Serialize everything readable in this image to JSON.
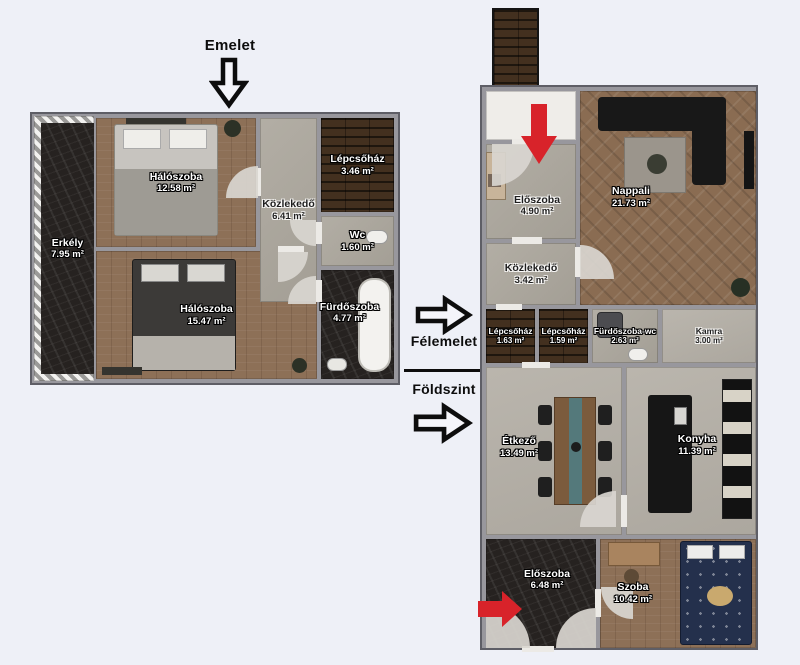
{
  "page": {
    "background": "#eef0f7"
  },
  "headings": {
    "emelet": "Emelet",
    "felemelet": "Félemelet",
    "foldszint": "Földszint"
  },
  "floors": {
    "emelet": {
      "rooms": [
        {
          "name": "Erkély",
          "area": "7.95 m²"
        },
        {
          "name": "Hálószoba",
          "area": "12.58 m²"
        },
        {
          "name": "Közlekedő",
          "area": "6.41 m²"
        },
        {
          "name": "Lépcsőház",
          "area": "3.46 m²"
        },
        {
          "name": "Wc",
          "area": "1.60 m²"
        },
        {
          "name": "Hálószoba",
          "area": "15.47 m²"
        },
        {
          "name": "Fürdőszoba",
          "area": "4.77 m²"
        }
      ]
    },
    "felemelet_foldszint": {
      "rooms": [
        {
          "name": "Előszoba",
          "area": "4.90 m²"
        },
        {
          "name": "Nappali",
          "area": "21.73 m²"
        },
        {
          "name": "Közlekedő",
          "area": "3.42 m²"
        },
        {
          "name": "Lépcsőház",
          "area": "1.63 m²"
        },
        {
          "name": "Lépcsőház",
          "area": "1.59 m²"
        },
        {
          "name": "Fürdőszoba-wc",
          "area": "2.63 m²"
        },
        {
          "name": "Kamra",
          "area": "3.00 m²"
        },
        {
          "name": "Étkező",
          "area": "13.49 m²"
        },
        {
          "name": "Konyha",
          "area": "11.39 m²"
        },
        {
          "name": "Előszoba",
          "area": "6.48 m²"
        },
        {
          "name": "Szoba",
          "area": "10.42 m²"
        }
      ]
    }
  },
  "colors": {
    "red_arrow": "#d8232a",
    "arrow_outline": "#0d0d0d",
    "wall": "#98979d"
  }
}
